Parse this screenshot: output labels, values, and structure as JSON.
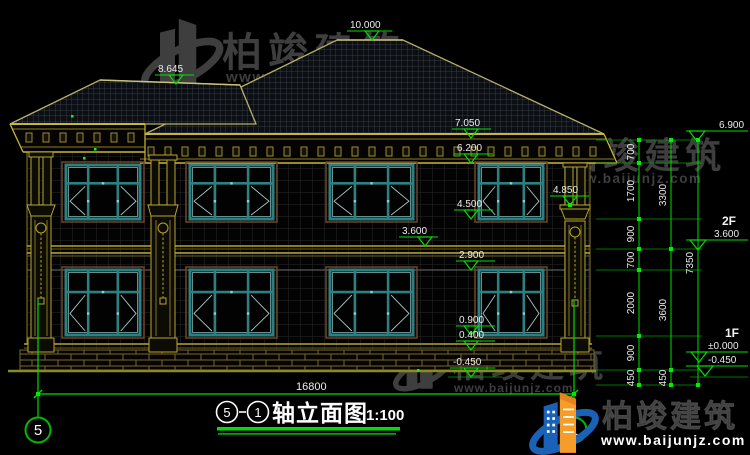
{
  "watermark": {
    "brand": "柏竣建筑",
    "url": "www.baijunjz.com"
  },
  "footer_logo": {
    "brand": "柏竣建筑",
    "url": "www.baijunjz.com"
  },
  "title": {
    "axis_start": "5",
    "axis_end": "1",
    "name": "轴立面图",
    "scale": "1:100"
  },
  "axis_bubbles": [
    {
      "label": "5",
      "cx": 38,
      "cy": 430
    },
    {
      "label": "1",
      "cx": 574,
      "cy": 430
    }
  ],
  "annotations": {
    "elevation_markers": [
      {
        "value": "10.000",
        "tx": 350,
        "ax": 372,
        "ay": 40
      },
      {
        "value": "8.645",
        "tx": 158,
        "ax": 176,
        "ay": 84
      },
      {
        "value": "7.050",
        "tx": 455,
        "ax": 471,
        "ay": 138
      },
      {
        "value": "6.200",
        "tx": 457,
        "ax": 471,
        "ay": 163
      },
      {
        "value": "4.500",
        "tx": 457,
        "ax": 471,
        "ay": 219
      },
      {
        "value": "3.600",
        "tx": 402,
        "ax": 425,
        "ay": 246
      },
      {
        "value": "2.900",
        "tx": 459,
        "ax": 471,
        "ay": 270
      },
      {
        "value": "4.850",
        "tx": 553,
        "ax": 570,
        "ay": 205
      },
      {
        "value": "0.900",
        "tx": 459,
        "ax": 471,
        "ay": 335
      },
      {
        "value": "0.400",
        "tx": 459,
        "ax": 471,
        "ay": 350
      },
      {
        "value": "-0.450",
        "tx": 453,
        "ax": 471,
        "ay": 377
      }
    ],
    "right_markers": [
      {
        "label": "",
        "value": "6.900",
        "tx": 719,
        "ly": 131,
        "ax": 697,
        "lx": 0
      },
      {
        "label": "2F",
        "value": "3.600",
        "tx": 714,
        "ly": 240,
        "ax": 698,
        "lx": 722
      },
      {
        "label": "1F",
        "value": "±0.000",
        "tx": 708,
        "ly": 352,
        "ax": 699,
        "lx": 725
      },
      {
        "label": "",
        "value": "-0.450",
        "tx": 708,
        "ly": 366,
        "ax": 705,
        "lx": 0
      }
    ],
    "chains": [
      {
        "x": 639,
        "nodes": [
          140,
          163,
          219,
          249,
          270,
          336,
          370,
          385
        ],
        "labels": [
          {
            "t": "700",
            "y": 152
          },
          {
            "t": "1700",
            "y": 191
          },
          {
            "t": "900",
            "y": 234
          },
          {
            "t": "700",
            "y": 260
          },
          {
            "t": "2000",
            "y": 303
          },
          {
            "t": "900",
            "y": 353
          },
          {
            "t": "450",
            "y": 378
          }
        ]
      },
      {
        "x": 671,
        "nodes": [
          140,
          249,
          370,
          385
        ],
        "labels": [
          {
            "t": "3300",
            "y": 195
          },
          {
            "t": "3600",
            "y": 310
          },
          {
            "t": "450",
            "y": 378
          }
        ]
      },
      {
        "x": 698,
        "nodes": [
          140,
          385
        ],
        "labels": [
          {
            "t": "7350",
            "y": 263
          }
        ]
      }
    ],
    "ext_lines_y": [
      140,
      163,
      219,
      249,
      270,
      336,
      370,
      385
    ],
    "total_width": {
      "value": "16800",
      "tx": 296,
      "y": 394,
      "x1": 38,
      "x2": 574
    }
  },
  "colors": {
    "background": "#000000",
    "dimension_green": "#00dd00",
    "structure_olive": "#b8a52c",
    "window_teal": "#2e8080",
    "watermark_gray": "#3e3e3e",
    "logo_blue": "#1a62b8",
    "logo_orange": "#f59d28"
  }
}
